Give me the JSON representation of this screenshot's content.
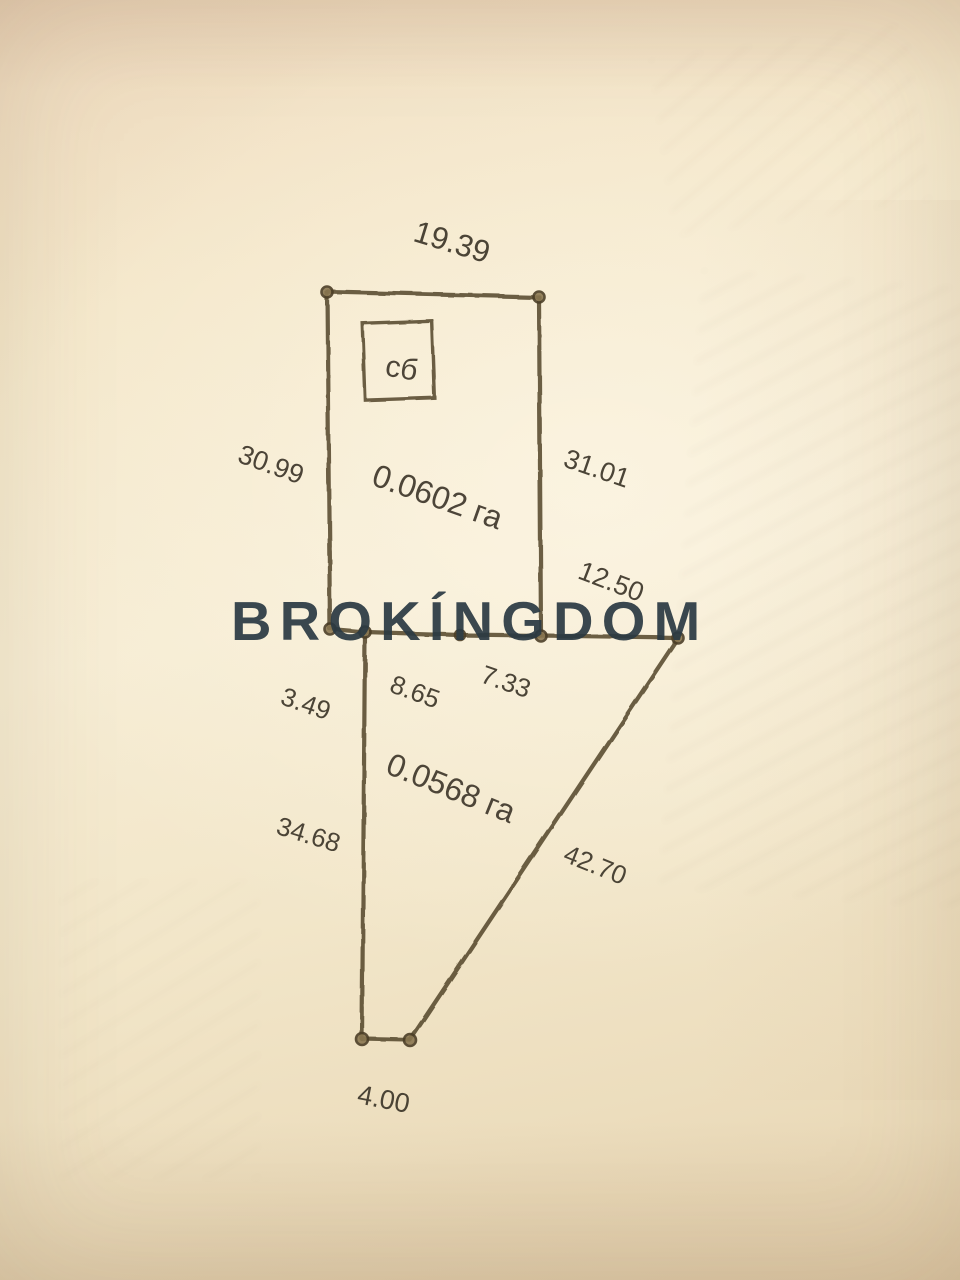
{
  "document": {
    "kind": "land-survey-parcel-sketch-photo",
    "watermark": {
      "text": "BROKÍNGDOM",
      "color": "#2c3b43"
    },
    "colors": {
      "paper": "#f4e8cc",
      "line": "#57492f",
      "label": "#3e372b"
    },
    "parcels": [
      {
        "id": "upper",
        "area_label": "0.0602 га",
        "building_mark": "сб"
      },
      {
        "id": "lower",
        "area_label": "0.0568 га"
      }
    ],
    "dimensions": {
      "top": "19.39",
      "upper_left": "30.99",
      "upper_right": "31.01",
      "right_offset": "12.50",
      "left_offset": "3.49",
      "shared_a": "8.65",
      "shared_b": "7.33",
      "lower_left": "34.68",
      "diagonal": "42.70",
      "bottom": "4.00"
    }
  }
}
